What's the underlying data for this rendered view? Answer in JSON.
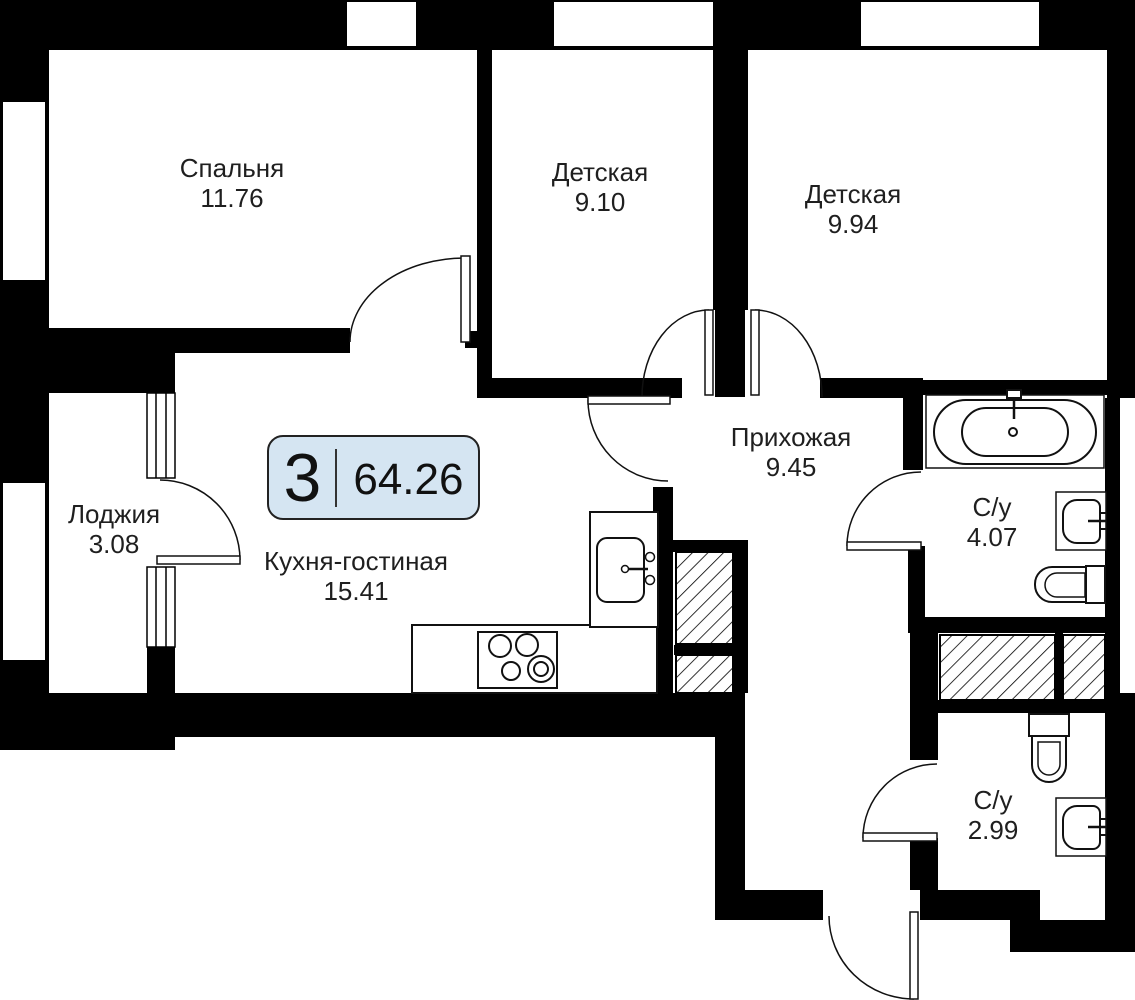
{
  "plan": {
    "badge": {
      "rooms_count": "3",
      "total_area": "64.26"
    },
    "rooms": [
      {
        "id": "bedroom",
        "name": "Спальня",
        "area": "11.76"
      },
      {
        "id": "kids-1",
        "name": "Детская",
        "area": "9.10"
      },
      {
        "id": "kids-2",
        "name": "Детская",
        "area": "9.94"
      },
      {
        "id": "hallway",
        "name": "Прихожая",
        "area": "9.45"
      },
      {
        "id": "bathroom-1",
        "name": "С/у",
        "area": "4.07"
      },
      {
        "id": "bathroom-2",
        "name": "С/у",
        "area": "2.99"
      },
      {
        "id": "kitchen",
        "name": "Кухня-гостиная",
        "area": "15.41"
      },
      {
        "id": "loggia",
        "name": "Лоджия",
        "area": "3.08"
      }
    ],
    "icons": [
      "bathtub-icon",
      "toilet-icon",
      "wall-sink-icon",
      "kitchen-sink-icon",
      "stove-icon",
      "door-arc",
      "window",
      "vent-shaft-hatch"
    ],
    "colors": {
      "wall": "#000000",
      "line": "#111111",
      "badge_fill": "#d5e5f2",
      "badge_border": "#222222",
      "text": "#1f1f1f"
    }
  }
}
